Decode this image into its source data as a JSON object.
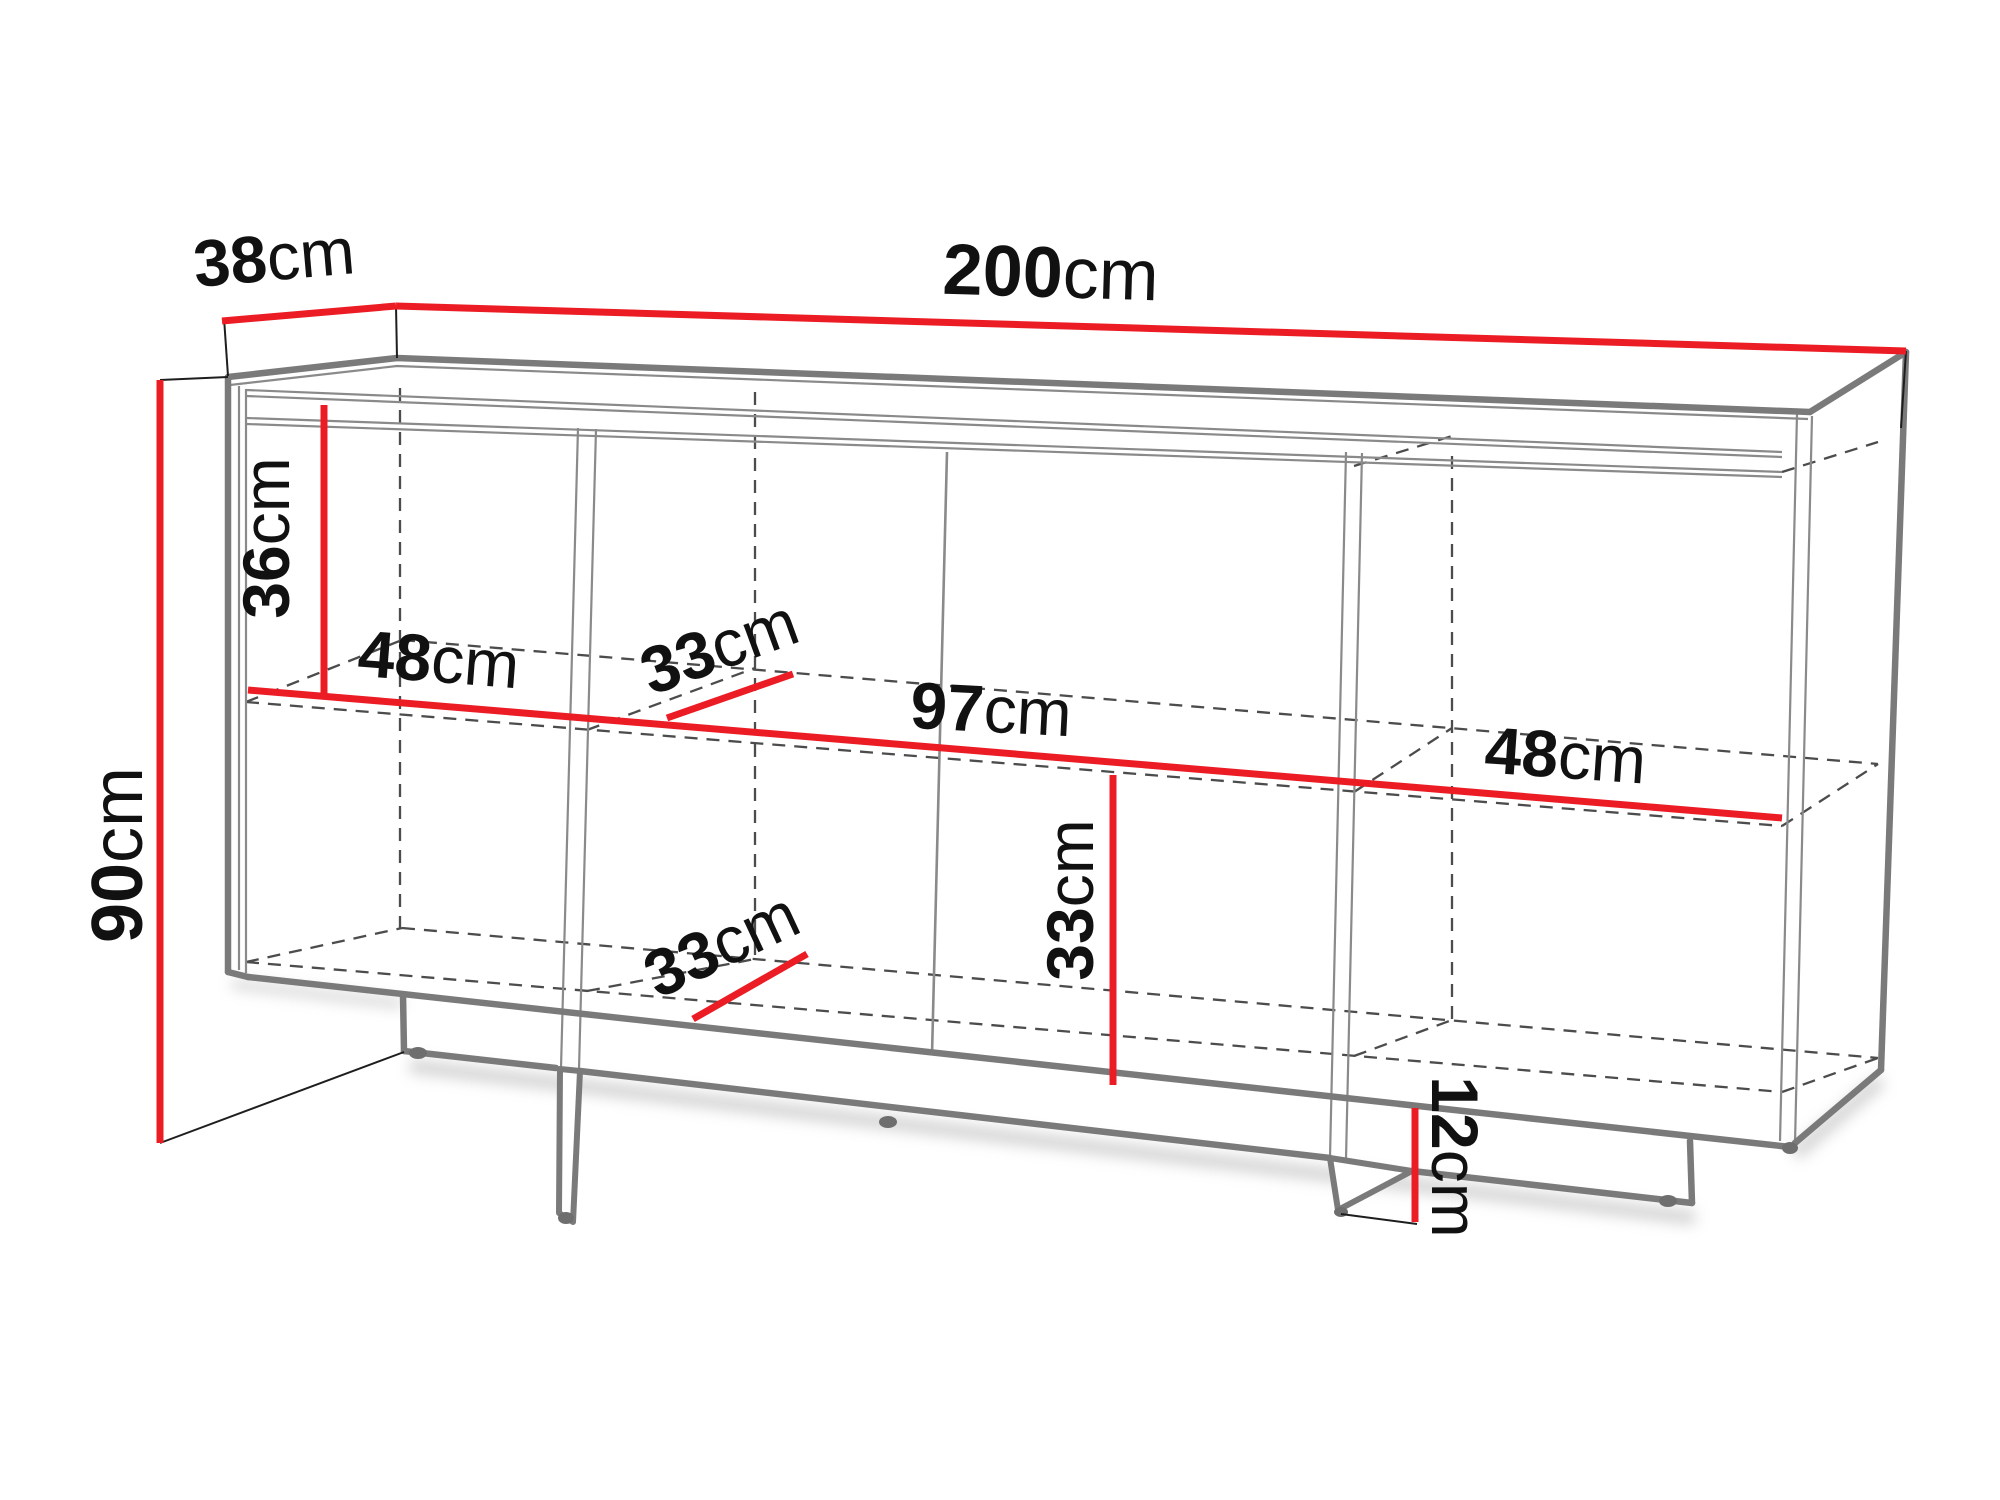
{
  "diagram": {
    "type": "furniture-dimension-drawing",
    "subject": "sideboard / commode technical sketch",
    "unit": "cm",
    "dimensions_cm": {
      "overall_width": 200,
      "overall_depth": 38,
      "overall_height": 90,
      "plinth_height": 12,
      "upper_inner_height": 36,
      "lower_inner_height": 33,
      "shelf_depth_top": 33,
      "shelf_depth_bottom": 33,
      "left_compartment_width": 48,
      "middle_compartment_width": 97,
      "right_compartment_width": 48
    },
    "labels": {
      "depth": {
        "value": "38",
        "unit": "cm"
      },
      "width": {
        "value": "200",
        "unit": "cm"
      },
      "height": {
        "value": "90",
        "unit": "cm"
      },
      "upper_inner": {
        "value": "36",
        "unit": "cm"
      },
      "left_comp": {
        "value": "48",
        "unit": "cm"
      },
      "shelf_depth_top": {
        "value": "33",
        "unit": "cm"
      },
      "middle_comp": {
        "value": "97",
        "unit": "cm"
      },
      "right_comp": {
        "value": "48",
        "unit": "cm"
      },
      "lower_inner": {
        "value": "33",
        "unit": "cm"
      },
      "shelf_depth_bottom": {
        "value": "33",
        "unit": "cm"
      },
      "plinth": {
        "value": "12",
        "unit": "cm"
      }
    },
    "colors": {
      "dimension": "#ec1c24",
      "outline": "#7a7a7a",
      "thin_line": "#8a8a8a",
      "dashed_line": "#4c4c4c",
      "extension_line": "#1e1e1e",
      "text": "#111111",
      "feet": "#6e6e6e",
      "shadow": "#c9c9c9",
      "background": "#ffffff"
    }
  }
}
